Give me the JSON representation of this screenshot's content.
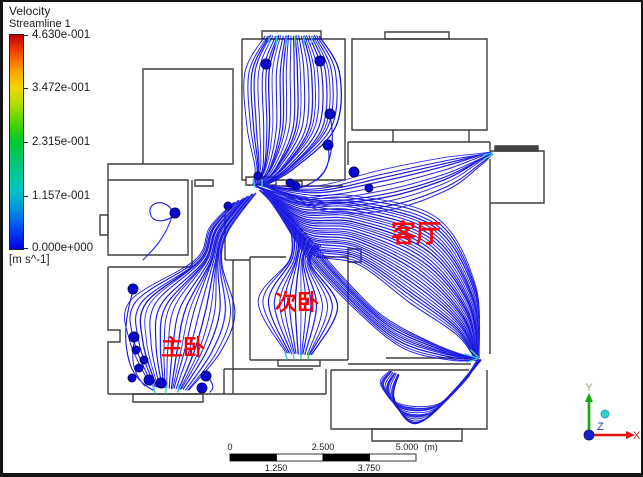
{
  "legend": {
    "title": "Velocity",
    "subtitle": "Streamline 1",
    "ticks": [
      "4.630e-001",
      "3.472e-001",
      "2.315e-001",
      "1.157e-001",
      "0.000e+000"
    ],
    "units": "[m s^-1]"
  },
  "rooms": [
    {
      "label": "客厅",
      "x": 413,
      "y": 240,
      "size": 25
    },
    {
      "label": "次卧",
      "x": 294,
      "y": 308,
      "size": 22
    },
    {
      "label": "主卧",
      "x": 180,
      "y": 353,
      "size": 22
    }
  ],
  "label_color": "#ff0000",
  "scale_bar": {
    "top_labels": [
      "0",
      "2.500",
      "5.000"
    ],
    "unit": "(m)",
    "bottom_labels": [
      "1.250",
      "3.750"
    ]
  },
  "axis": {
    "x": "X",
    "y": "Y",
    "z": "Z",
    "x_color": "#cc2222",
    "y_color": "#99a47c",
    "z_color": "#2a35b8"
  },
  "stream_palette": [
    "#0d0de0",
    "#1b1bef",
    "#0808c8",
    "#2626f2",
    "#1111da"
  ],
  "spheres": [
    [
      263,
      62,
      5
    ],
    [
      317,
      59,
      5
    ],
    [
      327,
      112,
      5
    ],
    [
      325,
      143,
      5
    ],
    [
      351,
      170,
      5
    ],
    [
      366,
      186,
      4
    ],
    [
      293,
      184,
      4
    ],
    [
      255,
      174,
      4
    ],
    [
      287,
      181,
      4
    ],
    [
      225,
      204,
      4
    ],
    [
      172,
      211,
      5
    ],
    [
      130,
      287,
      5
    ],
    [
      131,
      335,
      5
    ],
    [
      133,
      348,
      4
    ],
    [
      141,
      358,
      4
    ],
    [
      136,
      366,
      4
    ],
    [
      129,
      376,
      4
    ],
    [
      146,
      378,
      5
    ],
    [
      158,
      381,
      5
    ],
    [
      199,
      386,
      5
    ],
    [
      203,
      374,
      5
    ]
  ],
  "streamlines": {
    "bundles": [
      {
        "name": "inlet-fan",
        "count": 28,
        "points": [
          [
            289,
            34
          ],
          [
            289,
            70
          ],
          [
            288,
            125
          ],
          [
            272,
            165
          ],
          [
            257,
            182
          ]
        ],
        "spread": [
          [
            27,
            0
          ],
          [
            47,
            0
          ],
          [
            44,
            0
          ],
          [
            20,
            0
          ],
          [
            7,
            0
          ]
        ]
      },
      {
        "name": "corridor-to-outlet",
        "count": 30,
        "points": [
          [
            258,
            186
          ],
          [
            300,
            222
          ],
          [
            352,
            228
          ],
          [
            420,
            258
          ],
          [
            463,
            308
          ],
          [
            474,
            356
          ]
        ],
        "spread": [
          [
            6,
            2
          ],
          [
            3,
            26
          ],
          [
            3,
            34
          ],
          [
            -14,
            42
          ],
          [
            -10,
            24
          ],
          [
            -2,
            1
          ]
        ]
      },
      {
        "name": "living-lower-sweep",
        "count": 10,
        "points": [
          [
            260,
            190
          ],
          [
            300,
            240
          ],
          [
            345,
            290
          ],
          [
            390,
            330
          ],
          [
            440,
            350
          ],
          [
            472,
            357
          ]
        ],
        "spread": [
          [
            4,
            2
          ],
          [
            3,
            14
          ],
          [
            8,
            18
          ],
          [
            10,
            16
          ],
          [
            8,
            8
          ],
          [
            2,
            1
          ]
        ]
      },
      {
        "name": "corridor-to-right-exit",
        "count": 11,
        "points": [
          [
            257,
            183
          ],
          [
            315,
            196
          ],
          [
            380,
            188
          ],
          [
            440,
            172
          ],
          [
            473,
            158
          ],
          [
            488,
            151
          ]
        ],
        "spread": [
          [
            5,
            1
          ],
          [
            3,
            12
          ],
          [
            3,
            20
          ],
          [
            3,
            16
          ],
          [
            3,
            6
          ],
          [
            1,
            1
          ]
        ]
      },
      {
        "name": "hall-to-master",
        "count": 22,
        "points": [
          [
            242,
            196
          ],
          [
            216,
            228
          ],
          [
            206,
            260
          ],
          [
            180,
            305
          ],
          [
            172,
            345
          ],
          [
            167,
            386
          ]
        ],
        "spread": [
          [
            11,
            -5
          ],
          [
            9,
            2
          ],
          [
            13,
            2
          ],
          [
            52,
            6
          ],
          [
            45,
            6
          ],
          [
            19,
            2
          ]
        ]
      },
      {
        "name": "second-bedroom",
        "count": 16,
        "points": [
          [
            303,
            237
          ],
          [
            297,
            260
          ],
          [
            295,
            302
          ],
          [
            296,
            352
          ]
        ],
        "spread": [
          [
            15,
            7
          ],
          [
            11,
            2
          ],
          [
            40,
            3
          ],
          [
            13,
            1
          ]
        ]
      },
      {
        "name": "bottom-room-loops",
        "count": 12,
        "points": [
          [
            476,
            358
          ],
          [
            458,
            382
          ],
          [
            428,
            410
          ],
          [
            400,
            410
          ],
          [
            384,
            388
          ],
          [
            391,
            371
          ]
        ],
        "spread": [
          [
            2,
            0
          ],
          [
            -5,
            5
          ],
          [
            -6,
            8
          ],
          [
            5,
            9
          ],
          [
            7,
            7
          ],
          [
            5,
            2
          ]
        ]
      }
    ],
    "extras": [
      "M172,213 C160,222 148,220 147,210 C146,202 156,198 164,203 C170,207 170,212 169,216",
      "M169,214 C163,235 150,248 140,258",
      "M130,289 C122,315 120,340 127,362 C131,374 140,383 150,388",
      "M132,337 C127,355 130,372 142,384",
      "M203,374 C210,380 212,386 207,390",
      "M327,114 C331,132 330,152 322,168 C316,178 305,184 295,186",
      "M325,145 C328,158 324,170 314,178"
    ],
    "accents": [
      {
        "d": "M266,35 L266,43",
        "c": "#2fc8ea"
      },
      {
        "d": "M274,34 L273,44",
        "c": "#38d8c8"
      },
      {
        "d": "M283,34 L283,45",
        "c": "#2fc8ea"
      },
      {
        "d": "M292,34 L292,44",
        "c": "#45d06e"
      },
      {
        "d": "M301,34 L301,43",
        "c": "#2fc8ea"
      },
      {
        "d": "M309,35 L308,42",
        "c": "#38d8c8"
      },
      {
        "d": "M282,350 L284,357",
        "c": "#2fc8ea"
      },
      {
        "d": "M290,349 L291,357",
        "c": "#38d8c8"
      },
      {
        "d": "M298,349 L298,357",
        "c": "#2fc8ea"
      },
      {
        "d": "M306,350 L305,357",
        "c": "#45d06e"
      },
      {
        "d": "M150,384 L152,391",
        "c": "#2fc8ea"
      },
      {
        "d": "M163,384 L163,391",
        "c": "#38d8c8"
      },
      {
        "d": "M176,383 L175,390",
        "c": "#2fc8ea"
      },
      {
        "d": "M462,352 L474,356",
        "c": "#2fc8ea"
      },
      {
        "d": "M464,360 L474,357",
        "c": "#38d8c8"
      },
      {
        "d": "M468,348 L475,355",
        "c": "#45d06e"
      },
      {
        "d": "M480,153 L489,151",
        "c": "#2fc8ea"
      },
      {
        "d": "M481,157 L489,153",
        "c": "#38d8c8"
      },
      {
        "d": "M250,178 L252,185",
        "c": "#2fc8ea"
      },
      {
        "d": "M259,178 L259,185",
        "c": "#38d8c8"
      }
    ]
  }
}
